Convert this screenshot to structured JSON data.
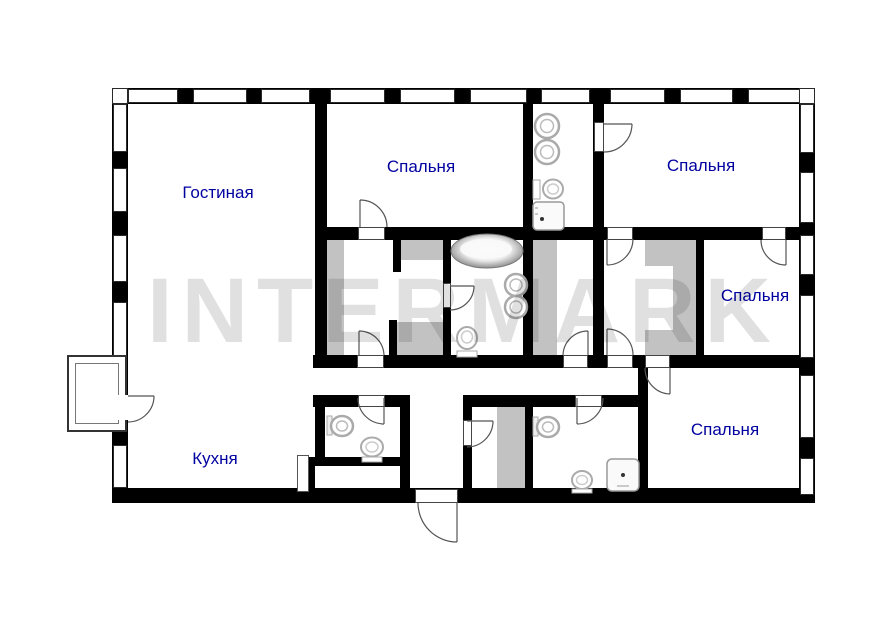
{
  "watermark": {
    "text": "INTERMARK"
  },
  "rooms": [
    {
      "id": "living",
      "label": "Гостиная"
    },
    {
      "id": "bedroom-1",
      "label": "Спальня"
    },
    {
      "id": "bedroom-2",
      "label": "Спальня"
    },
    {
      "id": "bedroom-3",
      "label": "Спальня"
    },
    {
      "id": "bedroom-4",
      "label": "Спальня"
    },
    {
      "id": "kitchen",
      "label": "Кухня"
    }
  ],
  "fixtures": [
    "bathtub",
    "sink",
    "toilet",
    "shower-tray",
    "wardrobe",
    "balcony",
    "entrance-door",
    "interior-door",
    "window"
  ],
  "colors": {
    "wall": "#000000",
    "label": "#0000A0",
    "wardrobe": "#c2c2c2",
    "watermark": "rgba(0,0,0,0.12)",
    "background": "#ffffff"
  }
}
